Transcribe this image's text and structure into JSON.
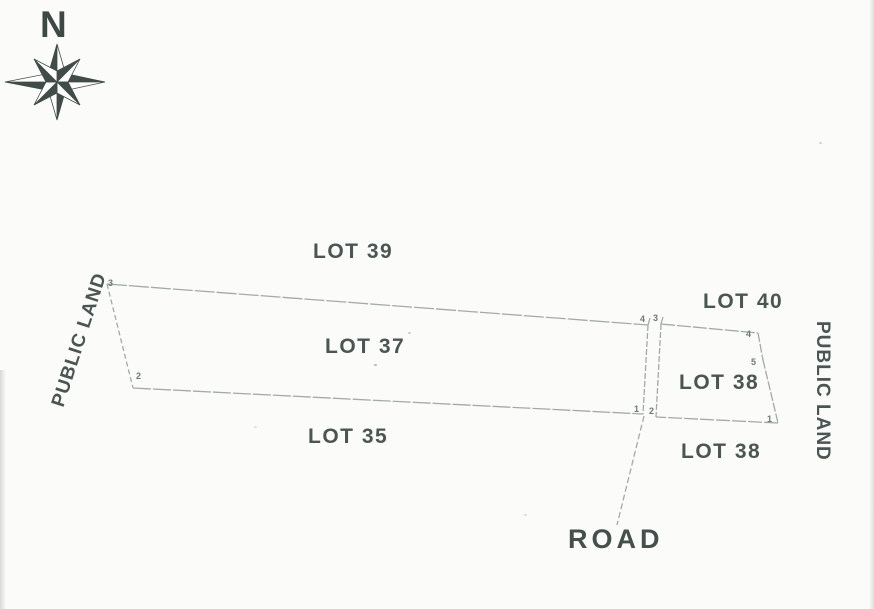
{
  "compass": {
    "north_label": "N"
  },
  "labels": {
    "lot39": "LOT 39",
    "lot37": "LOT 37",
    "lot35": "LOT 35",
    "lot40": "LOT 40",
    "lot38_inner": "LOT 38",
    "lot38_lower": "LOT 38",
    "public_land_left": "PUBLIC LAND",
    "public_land_right": "PUBLIC LAND",
    "road": "ROAD"
  },
  "corners": [
    {
      "label": "3"
    },
    {
      "label": "2"
    },
    {
      "label": "4"
    },
    {
      "label": "3"
    },
    {
      "label": "1"
    },
    {
      "label": "2"
    },
    {
      "label": "4"
    },
    {
      "label": "5"
    },
    {
      "label": "1"
    }
  ],
  "colors": {
    "ink": "#4b5552",
    "boundary_line": "#98a29d",
    "compass": "#414c48",
    "background": "#fbfcfa"
  }
}
